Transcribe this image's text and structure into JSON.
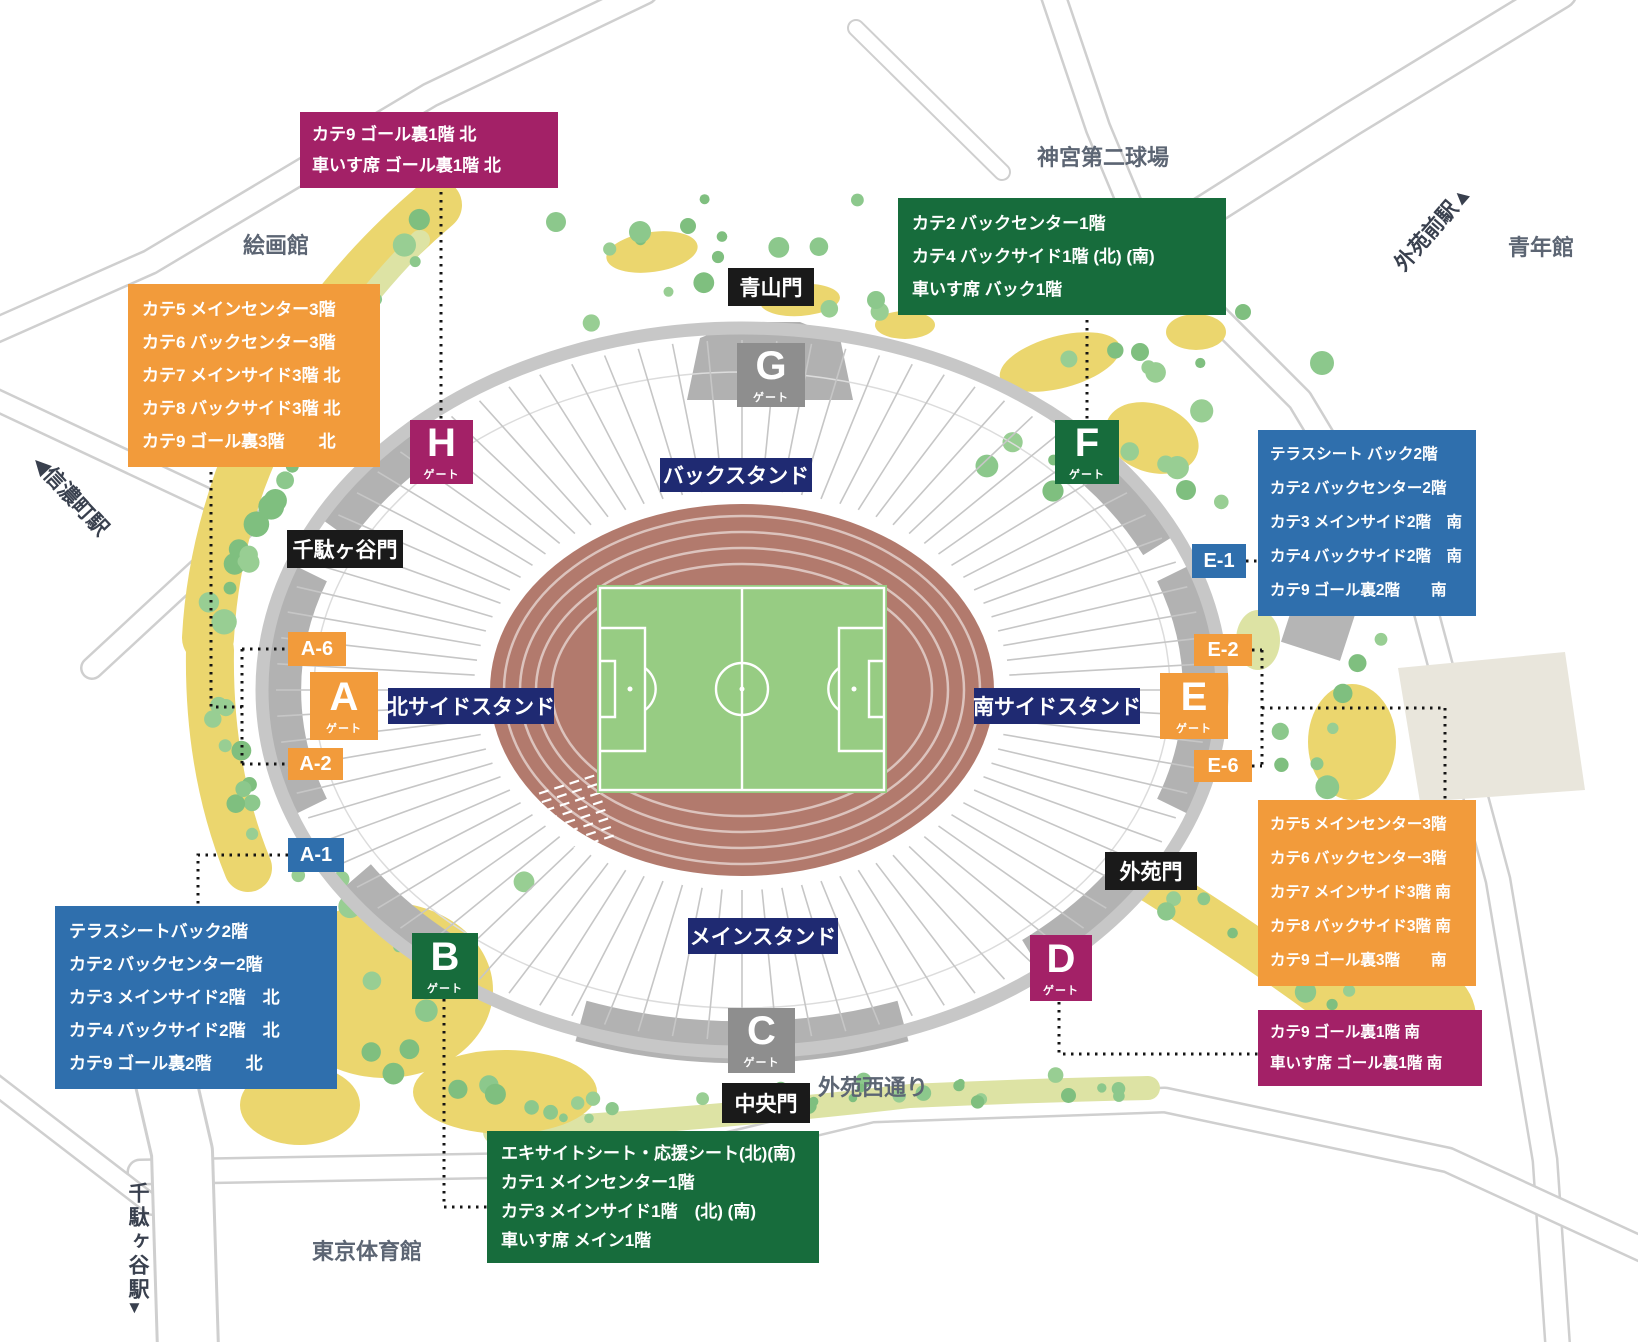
{
  "colors": {
    "orange": "#F29B3B",
    "green": "#176C3C",
    "blue": "#2F6FAD",
    "crimson": "#A32167",
    "navy_stand": "#1F2A72",
    "black_gate": "#1A1A1A",
    "gray_gate": "#8E8E8E",
    "field_green": "#97CC83",
    "track_brown": "#B27A6D",
    "tree_green": "#8CC88C",
    "ground_yellow": "#EBD66E"
  },
  "legend": {
    "goal1_north": {
      "lines": [
        "カテ9 ゴール裏1階 北",
        "車いす席 ゴール裏1階 北"
      ]
    },
    "cat3_north": {
      "lines": [
        "カテ5 メインセンター3階",
        "カテ6 バックセンター3階",
        "カテ7 メインサイド3階 北",
        "カテ8 バックサイド3階 北",
        "カテ9 ゴール裏3階　　北"
      ]
    },
    "back1": {
      "lines": [
        "カテ2 バックセンター1階",
        "カテ4 バックサイド1階 (北) (南)",
        "車いす席 バック1階"
      ]
    },
    "cat2_south": {
      "lines": [
        "テラスシート バック2階",
        "カテ2 バックセンター2階",
        "カテ3 メインサイド2階　南",
        "カテ4 バックサイド2階　南",
        "カテ9 ゴール裏2階　　南"
      ]
    },
    "cat2_north": {
      "lines": [
        "テラスシートバック2階",
        "カテ2 バックセンター2階",
        "カテ3 メインサイド2階　北",
        "カテ4 バックサイド2階　北",
        "カテ9 ゴール裏2階　　北"
      ]
    },
    "cat3_south": {
      "lines": [
        "カテ5 メインセンター3階",
        "カテ6 バックセンター3階",
        "カテ7 メインサイド3階 南",
        "カテ8 バックサイド3階 南",
        "カテ9 ゴール裏3階　　南"
      ]
    },
    "goal1_south": {
      "lines": [
        "カテ9 ゴール裏1階 南",
        "車いす席 ゴール裏1階 南"
      ]
    },
    "main1": {
      "lines": [
        "エキサイトシート・応援シート(北)(南)",
        "カテ1 メインセンター1階",
        "カテ3 メインサイド1階　(北) (南)",
        "車いす席 メイン1階"
      ]
    }
  },
  "gates": {
    "a": {
      "letter": "A",
      "word": "ゲート"
    },
    "b": {
      "letter": "B",
      "word": "ゲート"
    },
    "c": {
      "letter": "C",
      "word": "ゲート"
    },
    "d": {
      "letter": "D",
      "word": "ゲート"
    },
    "e": {
      "letter": "E",
      "word": "ゲート"
    },
    "f": {
      "letter": "F",
      "word": "ゲート"
    },
    "g": {
      "letter": "G",
      "word": "ゲート"
    },
    "h": {
      "letter": "H",
      "word": "ゲート"
    }
  },
  "sections": {
    "a6": "A-6",
    "a2": "A-2",
    "a1": "A-1",
    "e1": "E-1",
    "e2": "E-2",
    "e6": "E-6"
  },
  "stands": {
    "back": "バックスタンド",
    "north_side": "北サイドスタンド",
    "south_side": "南サイドスタンド",
    "main": "メインスタンド"
  },
  "entrances": {
    "aoyama": "青山門",
    "sendagaya": "千駄ヶ谷門",
    "gaien": "外苑門",
    "chuo": "中央門"
  },
  "landmarks": {
    "jingu_second_stadium": "神宮第二球場",
    "kaigakan": "絵画館",
    "seinenkan": "青年館",
    "tokyo_gymnasium": "東京体育館",
    "gaien_nishi_street": "外苑西通り",
    "gaienmae_station": "外苑前駅▲",
    "shinanomachi_station": "◀信濃町駅",
    "sendagaya_station": "千駄ヶ谷駅",
    "sendagaya_station_arrow": "▼"
  }
}
